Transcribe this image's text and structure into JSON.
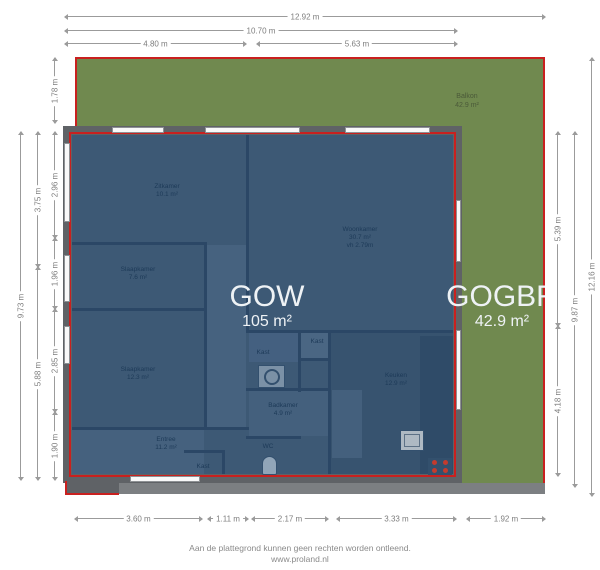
{
  "areas": {
    "gow": {
      "label": "GOW",
      "value": "105 m²"
    },
    "gogbr": {
      "label": "GOGBR",
      "value": "42.9 m²"
    },
    "balkon": {
      "name": "Balkon",
      "value": "42.9 m²"
    }
  },
  "rooms": [
    {
      "name": "Zitkamer",
      "area": "10.1 m²"
    },
    {
      "name": "Woonkamer",
      "area": "30.7 m²",
      "height_note": "vh 2.79m"
    },
    {
      "name": "Slaapkamer",
      "area": "7.6 m²"
    },
    {
      "name": "Slaapkamer",
      "area": "12.3 m²"
    },
    {
      "name": "Entree",
      "area": "11.2 m²"
    },
    {
      "name": "Badkamer",
      "area": "4.9 m²"
    },
    {
      "name": "Keuken",
      "area": "12.9 m²"
    },
    {
      "name": "Kast"
    },
    {
      "name": "Kast"
    },
    {
      "name": "Kast"
    },
    {
      "name": "WC"
    }
  ],
  "dimensions": {
    "top": [
      "12.92 m",
      "10.70 m",
      "4.80 m",
      "5.63 m"
    ],
    "bottom": [
      "3.60 m",
      "1.11 m",
      "2.17 m",
      "3.33 m",
      "1.92 m"
    ],
    "left": [
      "1.78 m",
      "9.73 m",
      "3.75 m",
      "5.88 m",
      "2.96 m",
      "1.96 m",
      "2.85 m",
      "1.90 m"
    ],
    "right": [
      "5.39 m",
      "4.18 m",
      "9.87 m",
      "12.16 m"
    ]
  },
  "footer": {
    "line1": "Aan de plattegrond kunnen geen rechten worden ontleend.",
    "line2": "www.proland.nl"
  },
  "colors": {
    "balcony_green": "#70894f",
    "outline_red": "#c9201f",
    "floor_blue": "#3d5975",
    "wall_gray": "#5f6266"
  }
}
